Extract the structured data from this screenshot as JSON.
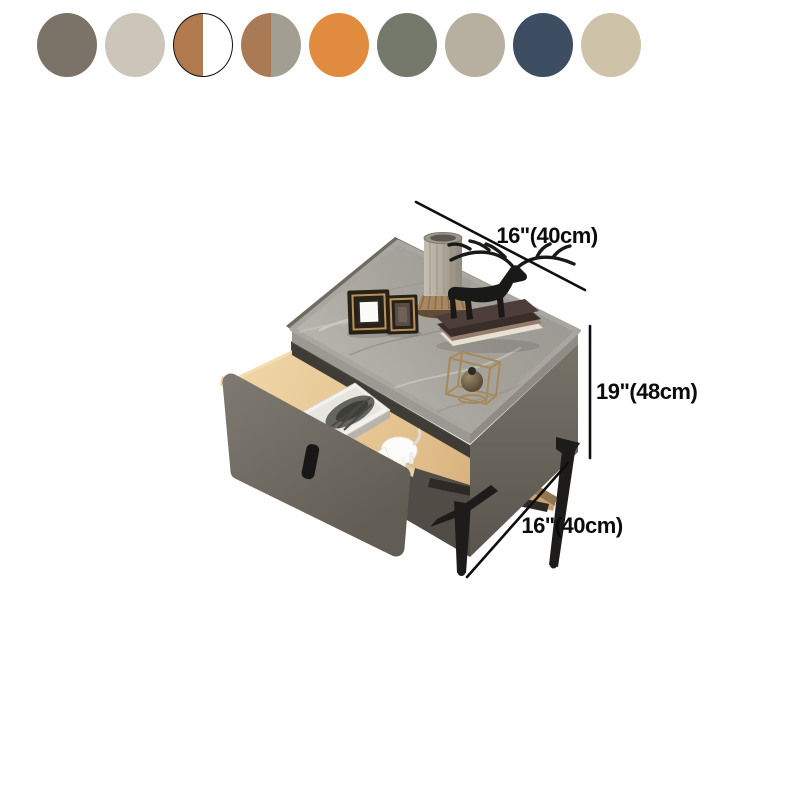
{
  "swatches": {
    "items": [
      {
        "name": "dark-taupe",
        "type": "solid",
        "color": "#7b7368",
        "selected": false
      },
      {
        "name": "light-greige",
        "type": "solid",
        "color": "#cbc6b9",
        "selected": false
      },
      {
        "name": "walnut-white",
        "type": "split",
        "left": "#b17a4e",
        "right": "#ffffff",
        "selected": true
      },
      {
        "name": "walnut-gray",
        "type": "split",
        "left": "#aa7a54",
        "right": "#a39e92",
        "selected": false
      },
      {
        "name": "orange",
        "type": "solid",
        "color": "#e08b3d",
        "selected": false
      },
      {
        "name": "sage-gray",
        "type": "solid",
        "color": "#75796b",
        "selected": false
      },
      {
        "name": "warm-gray",
        "type": "solid",
        "color": "#b7b0a0",
        "selected": false
      },
      {
        "name": "slate-blue",
        "type": "solid",
        "color": "#3d4e62",
        "selected": false
      },
      {
        "name": "sand",
        "type": "solid",
        "color": "#cec2a8",
        "selected": false
      }
    ]
  },
  "dimensions": {
    "top_width": "16\"(40cm)",
    "height": "19\"(48cm)",
    "depth": "16\"(40cm)"
  }
}
